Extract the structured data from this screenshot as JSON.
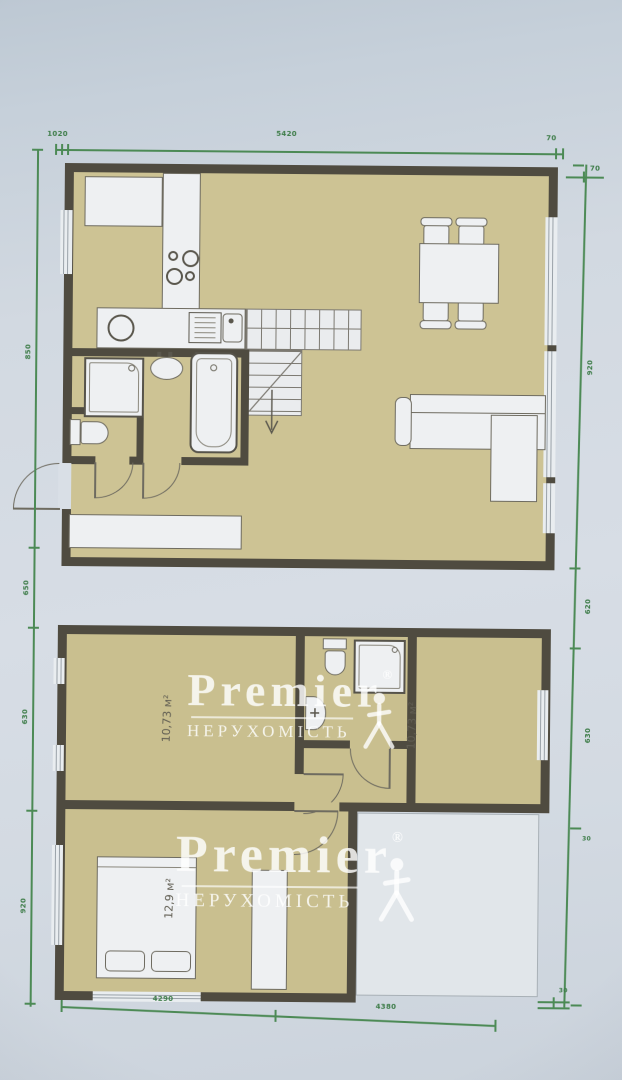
{
  "watermark": {
    "brand": "Premier",
    "registered": "®",
    "subtitle": "НЕРУХОМІСТЬ",
    "person_icon": "walking-person-icon"
  },
  "floor_plans": {
    "upper_floor": {
      "name": "ground-floor-plan",
      "rooms": [
        "kitchen",
        "living-dining-room",
        "bathroom",
        "wc",
        "hallway"
      ],
      "furniture": [
        "kitchen-cabinet",
        "kitchen-counter",
        "stove",
        "kitchen-sink",
        "washing-machine",
        "stairs",
        "shower-cabin",
        "toilet",
        "wash-basin",
        "bathtub",
        "hallway-cabinet",
        "dining-table",
        "chairs",
        "corner-sofa"
      ]
    },
    "lower_floor": {
      "name": "first-floor-plan",
      "room_labels": {
        "left_room_area": "10,73 м²",
        "right_room_area": "10,73 м²",
        "bedroom_area": "12,9 м²"
      },
      "furniture": [
        "toilet",
        "shower-cabin",
        "wash-basin",
        "double-bed",
        "wardrobe"
      ]
    }
  },
  "dimensions": {
    "top": {
      "left_offset": "1020",
      "total": "5420",
      "right": "70",
      "stub": "70"
    },
    "left": {
      "seg1": "850",
      "seg2": "650",
      "seg3": "630",
      "seg4": "920"
    },
    "right": {
      "seg1": "920",
      "seg2": "620",
      "seg3": "630",
      "seg4": "30"
    },
    "bottom": {
      "seg1": "4290",
      "seg2": "4380",
      "stub": "30"
    }
  },
  "colors": {
    "wall": "#4f4b40",
    "floor_upper": "#cdc394",
    "floor_lower": "#c9bf8f",
    "dimension_green": "#4c8a55",
    "paper": "#d7dde5"
  }
}
